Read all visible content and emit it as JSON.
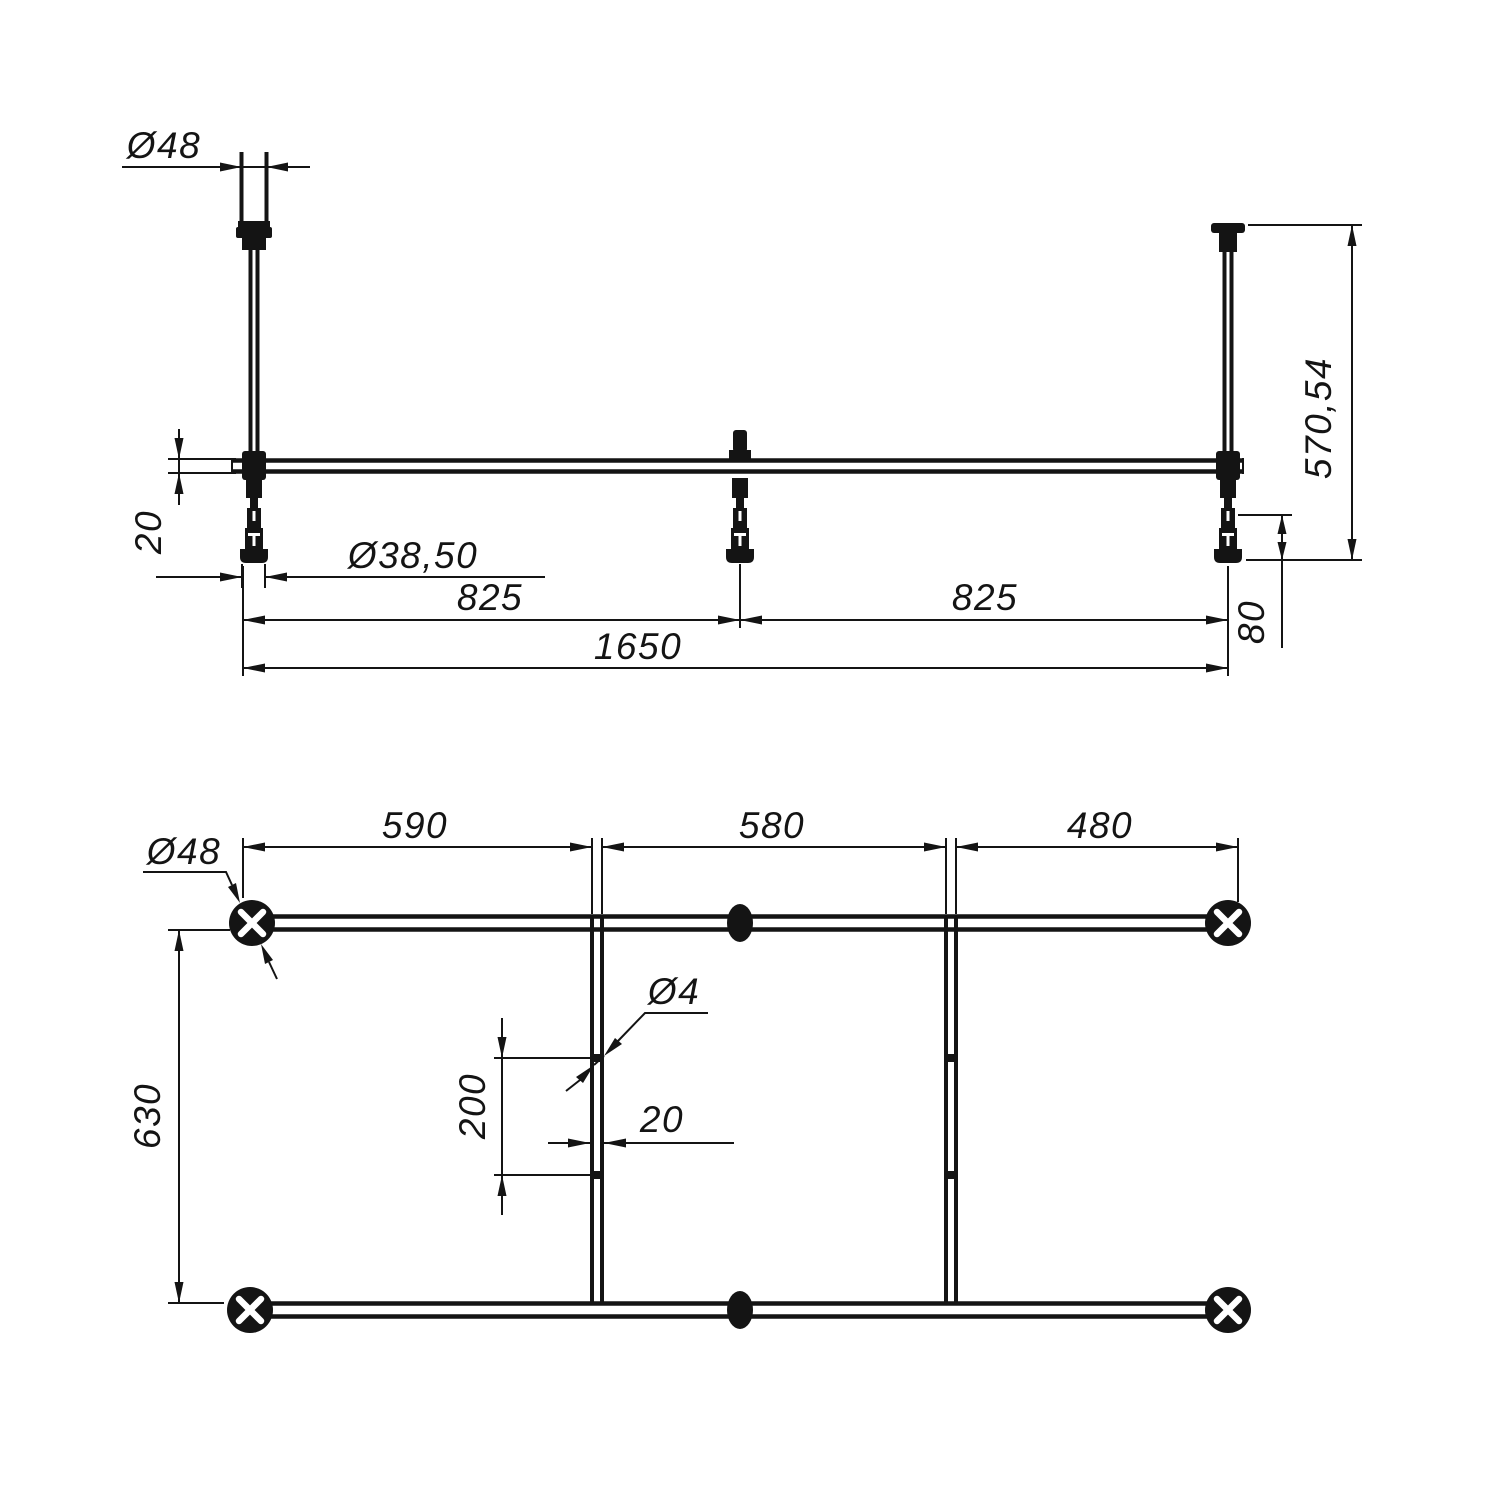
{
  "colors": {
    "ink": "#141414",
    "background": "#ffffff"
  },
  "drawing_type": "technical dimension drawing, bathtub support frame, front elevation and plan view",
  "dims": {
    "front_dia_48": "Ø48",
    "front_bar_20": "20",
    "front_dia_38_50": "Ø38,50",
    "front_span_825_left": "825",
    "front_span_825_right": "825",
    "front_total_1650": "1650",
    "front_height_570_54": "570,54",
    "front_foot_80": "80",
    "plan_seg_590": "590",
    "plan_seg_580": "580",
    "plan_seg_480": "480",
    "plan_dia_48": "Ø48",
    "plan_dia_4": "Ø4",
    "plan_offset_200": "200",
    "plan_rail_20": "20",
    "plan_width_630": "630"
  }
}
